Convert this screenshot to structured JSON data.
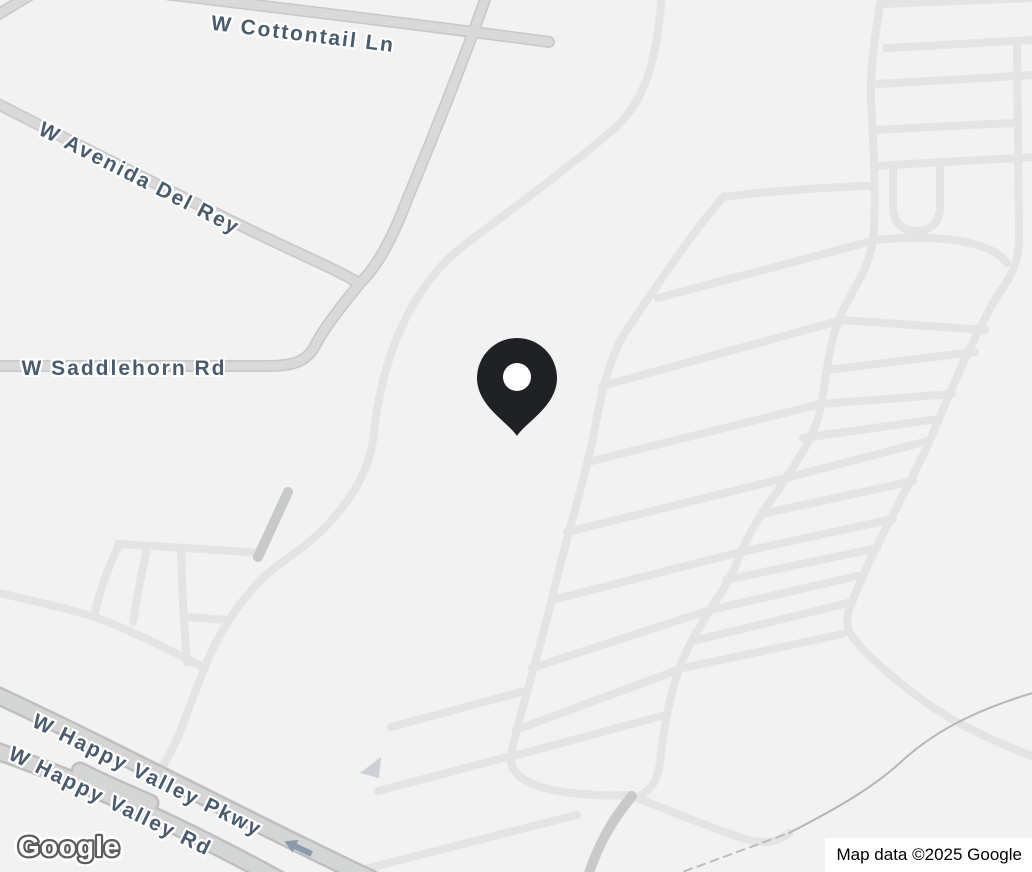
{
  "map": {
    "palette": {
      "land": "#f1f2f1",
      "road_light": "#e3e4e3",
      "road_main_fill": "#d8d9d8",
      "road_main_edge": "#c7c8c8",
      "road_wide_fill": "#d4d5d5",
      "road_wide_edge": "#bec0c0",
      "road_dark": "#c8caca",
      "path_thin": "#b5b7b6",
      "path_dashed": "#bdbdbd",
      "label_color": "#4a5b6d",
      "pin_color": "#1f2125",
      "arrow_color": "#8c9aad",
      "oneway_triangle_color": "#ccd1d8"
    },
    "road_labels": [
      {
        "text": "W Cottontail Ln",
        "x": 303,
        "y": 35,
        "rotate": 7
      },
      {
        "text": "W Avenida Del Rey",
        "x": 139,
        "y": 179,
        "rotate": 27
      },
      {
        "text": "W Saddlehorn Rd",
        "x": 124,
        "y": 369,
        "rotate": 0
      },
      {
        "text": "W Happy Valley Pkwy",
        "x": 147,
        "y": 776,
        "rotate": 26
      },
      {
        "text": "W Happy Valley Rd",
        "x": 110,
        "y": 802,
        "rotate": 26
      }
    ],
    "marker": {
      "name": "location-pin",
      "tip_x": 517,
      "tip_y": 436
    },
    "roads": {
      "light": [
        "M662,-6 C657,55 648,98 614,129 C578,160 505,215 467,243 C428,272 384,330 373,440 C369,474 342,522 285,560 C243,588 214,642 204,669 C199,682 192,700 186,716 C178,740 170,753 161,770",
        "M723,197 C768,191 830,187 871,186",
        "M724,196 C692,232 650,296 628,328 C608,357 599,404 592,443 C581,492 566,540 554,590 C542,644 517,722 511,755 C508,774 528,786 558,791 C589,796 616,796 630,795",
        "M882,-6 C874,40 870,70 871,100 C873,135 877,205 873,240 C869,268 856,284 843,310 C829,340 827,372 821,406 C814,441 794,464 777,492 C755,520 743,546 735,567 C725,590 713,603 705,618 C695,636 684,652 678,672 C670,696 663,730 660,762 C658,780 651,790 641,795",
        "M1017,46 L1019,232 C1020,261 1011,277 1000,292 C976,330 951,390 927,447 C906,492 873,548 853,600 C845,616 845,628 854,639 C869,657 906,692 950,718 C984,737 1011,748 1034,757",
        "M884,4 L1034,-2",
        "M886,48 C940,45 995,42 1034,40",
        "M878,84 C940,80 995,77 1034,75",
        "M876,130 C930,127 985,124 1018,123",
        "M874,166 C930,163 985,160 1034,157",
        "M893,169 L893,207 C893,224 904,231 916,231 C929,231 940,224 940,207 L940,169",
        "M658,298 L876,240 C935,234 990,240 1007,263",
        "M602,386 L842,320 L985,330",
        "M588,462 L821,404 L952,394",
        "M567,532 L786,478 L928,441",
        "M552,600 L741,552 L893,519",
        "M532,668 L710,610 L862,575",
        "M516,730 L683,668 L843,634",
        "M510,757 L665,715",
        "M827,370 L975,352",
        "M803,438 L939,419",
        "M762,514 L913,481",
        "M726,580 L877,548",
        "M697,640 L852,602",
        "M391,727 L521,692",
        "M378,791 L511,756",
        "M353,872 L577,815",
        "M-5,592 C60,607 95,615 120,627 C150,640 180,655 205,668",
        "M118,544 C160,547 215,549 255,553",
        "M119,545 C108,568 100,590 95,612",
        "M147,549 C140,580 136,602 133,622",
        "M181,550 C182,590 184,625 187,662",
        "M187,617 L227,620",
        "M632,796 C668,810 706,826 742,838 C766,846 780,841 789,833"
      ],
      "main": [
        "M148,-8 C280,8 440,27 549,42",
        "M489,-12 C472,38 440,120 407,200 C391,242 376,268 360,283 C344,303 324,328 316,344 C308,361 294,366 268,366 L-10,366",
        "M-10,100 C80,146 180,196 250,230 C292,251 332,267 359,283",
        "M-8,18 L32,-6"
      ],
      "wide": [
        "M-10,692 C120,752 265,830 395,890",
        "M-12,748 C90,783 200,835 298,890",
        "M80,771 C103,783 125,792 150,803"
      ],
      "dark": [
        "M258,557 L288,492",
        "M632,796 C612,820 598,845 588,876"
      ],
      "thin": [
        "M789,833 C830,812 872,789 902,761 C940,726 988,706 1036,692"
      ],
      "dashed": [
        "M658,881 L789,833"
      ]
    }
  },
  "footer": {
    "logo": "Google",
    "attribution": "Map data ©2025 Google"
  }
}
